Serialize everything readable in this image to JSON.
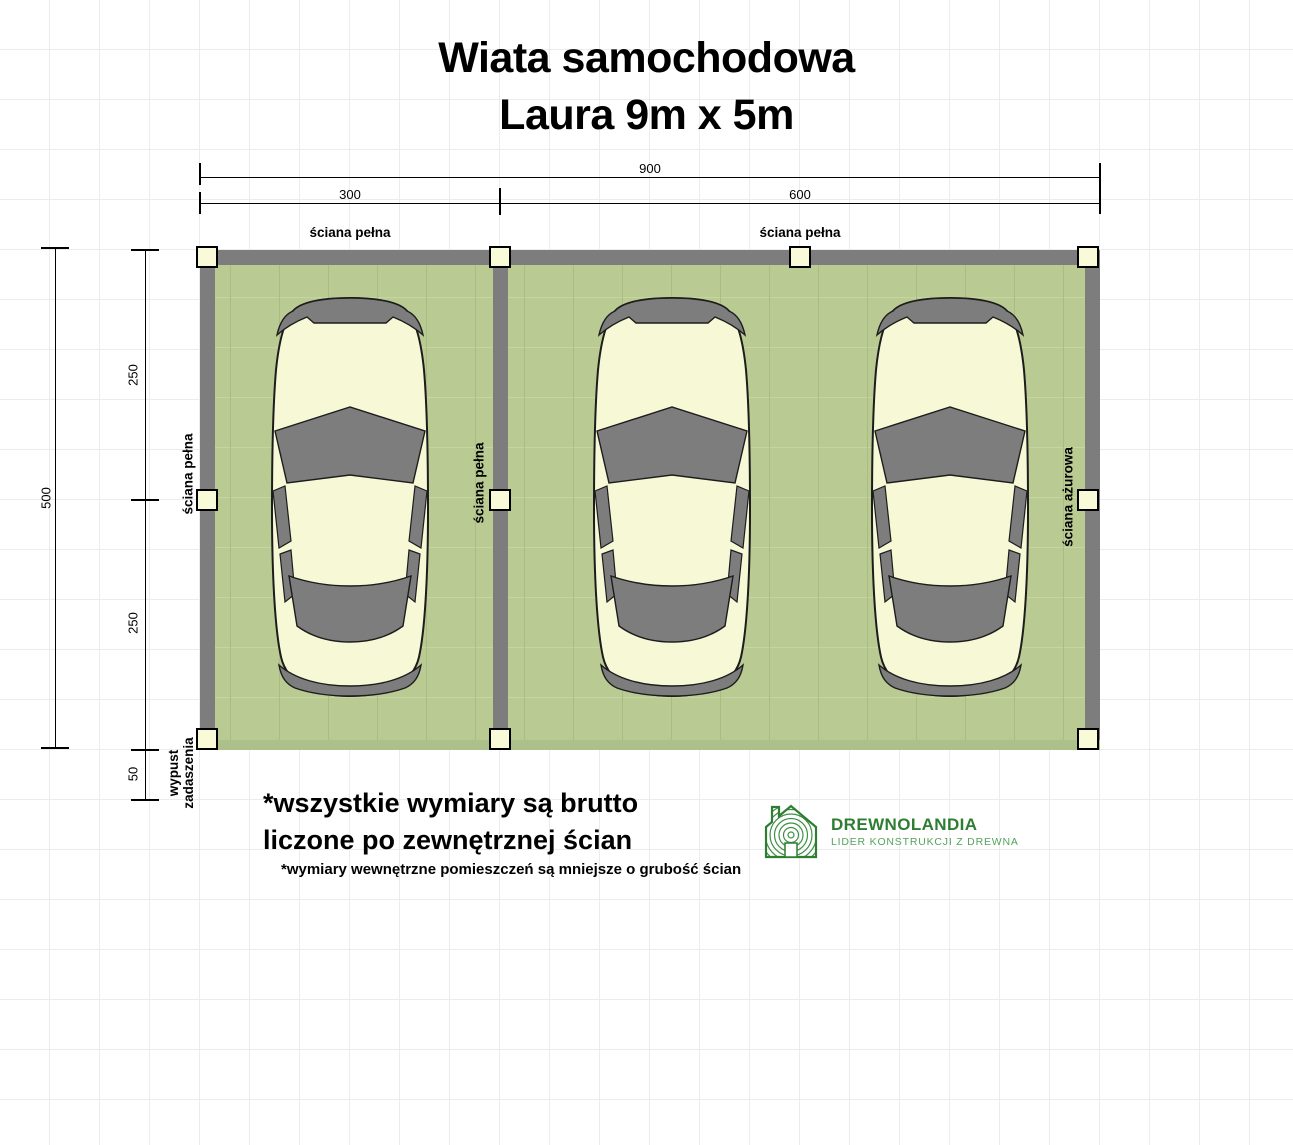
{
  "title": {
    "line1": "Wiata samochodowa",
    "line2": "Laura 9m x 5m"
  },
  "dimensions": {
    "total_width": "900",
    "bay1_width": "300",
    "bay2_width": "600",
    "total_depth": "500",
    "front_depth": "250",
    "rear_depth": "250",
    "roof_overhang": "50"
  },
  "wall_labels": {
    "top_left_bay": "ściana pełna",
    "top_right_bay": "ściana pełna",
    "left": "ściana pełna",
    "middle": "ściana pełna",
    "right": "ściana ażurowa"
  },
  "overhang_label": {
    "line1": "wypust",
    "line2": "zadaszenia"
  },
  "notes": {
    "line1": "*wszystkie wymiary są brutto",
    "line2": "liczone po zewnętrznej ścian",
    "line3": "*wymiary wewnętrzne pomieszczeń są mniejsze o grubość ścian"
  },
  "logo": {
    "name": "DREWNOLANDIA",
    "tagline": "LIDER KONSTRUKCJI Z DREWNA"
  },
  "colors": {
    "floor_green": "#b9cb92",
    "wall_gray": "#7d7d7d",
    "post_fill": "#f9fbd8",
    "car_body": "#f7f9d6",
    "car_glass": "#7d7d7d",
    "logo_green": "#2e7d33",
    "logo_green_light": "#55a35c"
  }
}
